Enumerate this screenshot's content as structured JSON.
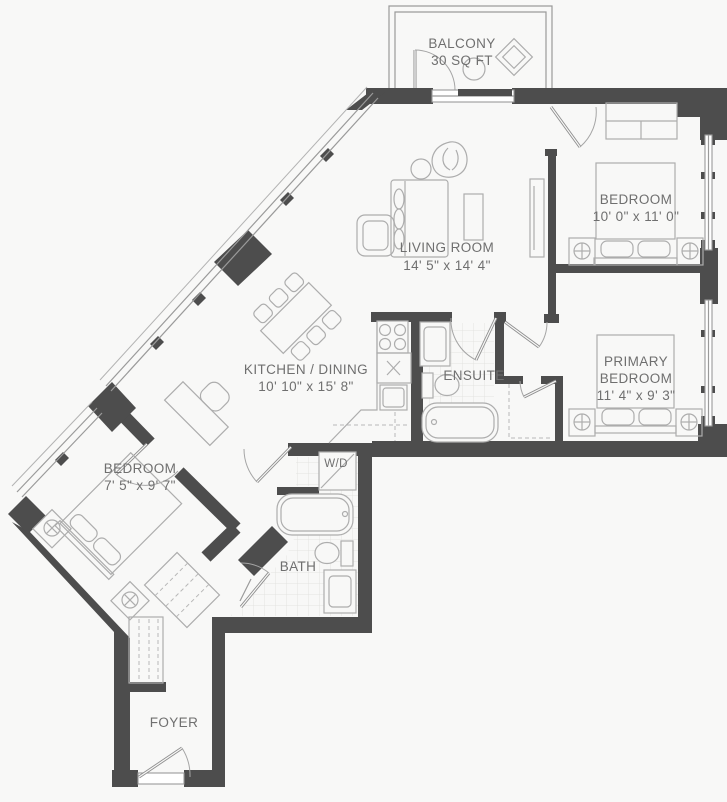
{
  "colors": {
    "wall": "#4d4d4d",
    "window": "#9a9a9a",
    "furniture": "#adadad",
    "label_text": "#6f6f6f",
    "tile_grid": "#e3e3e1",
    "background": "#f8f8f7"
  },
  "rooms": {
    "balcony": {
      "name": "BALCONY",
      "area": "30 SQ FT"
    },
    "living_room": {
      "name": "LIVING ROOM",
      "dims": "14' 5\" x 14' 4\""
    },
    "bedroom": {
      "name": "BEDROOM",
      "dims": "10' 0\" x 11' 0\""
    },
    "primary_bedroom": {
      "name_line1": "PRIMARY",
      "name_line2": "BEDROOM",
      "dims": "11' 4\" x 9' 3\""
    },
    "kitchen_dining": {
      "name": "KITCHEN / DINING",
      "dims": "10' 10\" x 15' 8\""
    },
    "ensuite": {
      "name": "ENSUITE"
    },
    "bedroom2": {
      "name": "BEDROOM",
      "dims": "7' 5\" x 9' 7\""
    },
    "bath": {
      "name": "BATH"
    },
    "laundry": {
      "name": "W/D"
    },
    "foyer": {
      "name": "FOYER"
    }
  }
}
